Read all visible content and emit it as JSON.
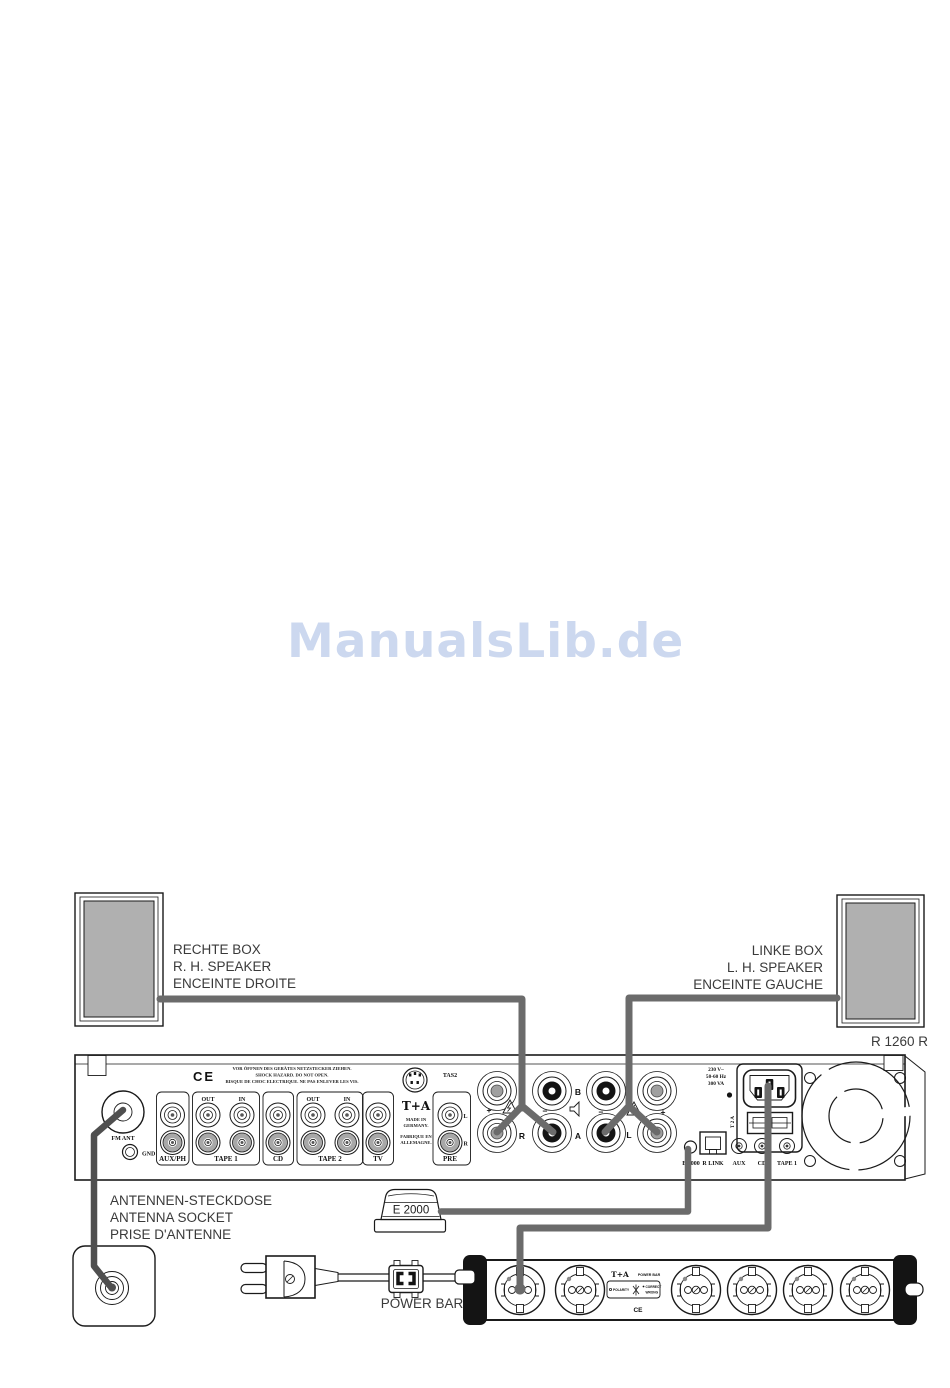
{
  "watermark": {
    "text": "ManualsLib.de"
  },
  "model_label": "R 1260 R",
  "colors": {
    "cable": "#6b6b6b",
    "antenna_cable": "#4f4f4f",
    "speaker_fill": "#b0b0b0",
    "watermark": "#ccd8ef"
  },
  "speaker_labels": {
    "right": [
      "RECHTE BOX",
      "R. H. SPEAKER",
      "ENCEINTE DROITE"
    ],
    "left": [
      "LINKE BOX",
      "L. H. SPEAKER",
      "ENCEINTE GAUCHE"
    ]
  },
  "antenna_labels": [
    "ANTENNEN-STECKDOSE",
    "ANTENNA SOCKET",
    "PRISE D'ANTENNE"
  ],
  "e2000_box_label": "E 2000",
  "power_bar_label": "POWER BAR",
  "panel": {
    "ce": "CE",
    "warning": [
      "VOR ÖFFNEN DES GERÄTES NETZSTECKER ZIEHEN.",
      "SHOCK HAZARD. DO NOT OPEN.",
      "RISQUE DE CHOC ELECTRIQUE. NE PAS ENLEVER LES VIS."
    ],
    "fm_ant": "FM ANT",
    "gnd": "GND",
    "aux_ph": "AUX/PH",
    "out": "OUT",
    "in": "IN",
    "tape1": "TAPE 1",
    "cd": "CD",
    "tape2": "TAPE 2",
    "tv": "TV",
    "brand": "T+A",
    "made_in": [
      "MADE IN",
      "GERMANY."
    ],
    "fabrique": [
      "FABRIQUE EN",
      "ALLEMAGNE."
    ],
    "tas2": "TAS2",
    "pre": "PRE",
    "pre_l": "L",
    "pre_r": "R",
    "terminals": {
      "b": "B",
      "a": "A",
      "r": "R",
      "l": "L",
      "plus": "+",
      "minus": "−"
    },
    "power_rating": [
      "230 V~",
      "50-60 Hz",
      "300 VA"
    ],
    "fuse": "T 2 A",
    "bottom_row": {
      "e2000": "E 2000",
      "r_link": "R LINK",
      "aux": "AUX",
      "cd": "CD",
      "tape1": "TAPE 1"
    }
  },
  "power_bar": {
    "brand": "T+A",
    "name": "POWER BAR",
    "polarity": "POLARITY",
    "correct": "CORRECT",
    "wrong": "WRONG",
    "ce": "CE"
  }
}
